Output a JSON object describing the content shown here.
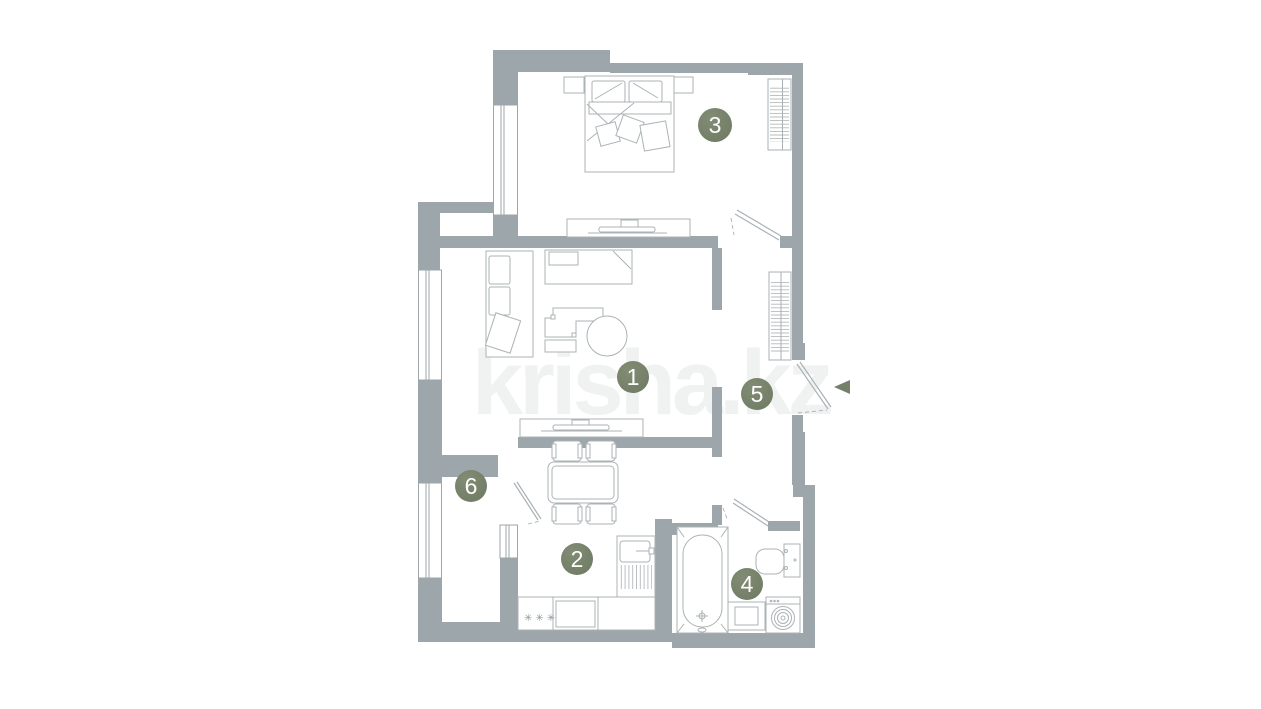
{
  "watermark_text": "krisha.kz",
  "rooms": [
    {
      "number": "1"
    },
    {
      "number": "2"
    },
    {
      "number": "3"
    },
    {
      "number": "4"
    },
    {
      "number": "5"
    },
    {
      "number": "6"
    }
  ],
  "stove_burners_symbol": "✳✳✳",
  "colors": {
    "wall": "#9da6ab",
    "furniture_line": "#abb3b6",
    "badge": "#75806b",
    "background": "#ffffff",
    "watermark": "#f0f1f1"
  }
}
